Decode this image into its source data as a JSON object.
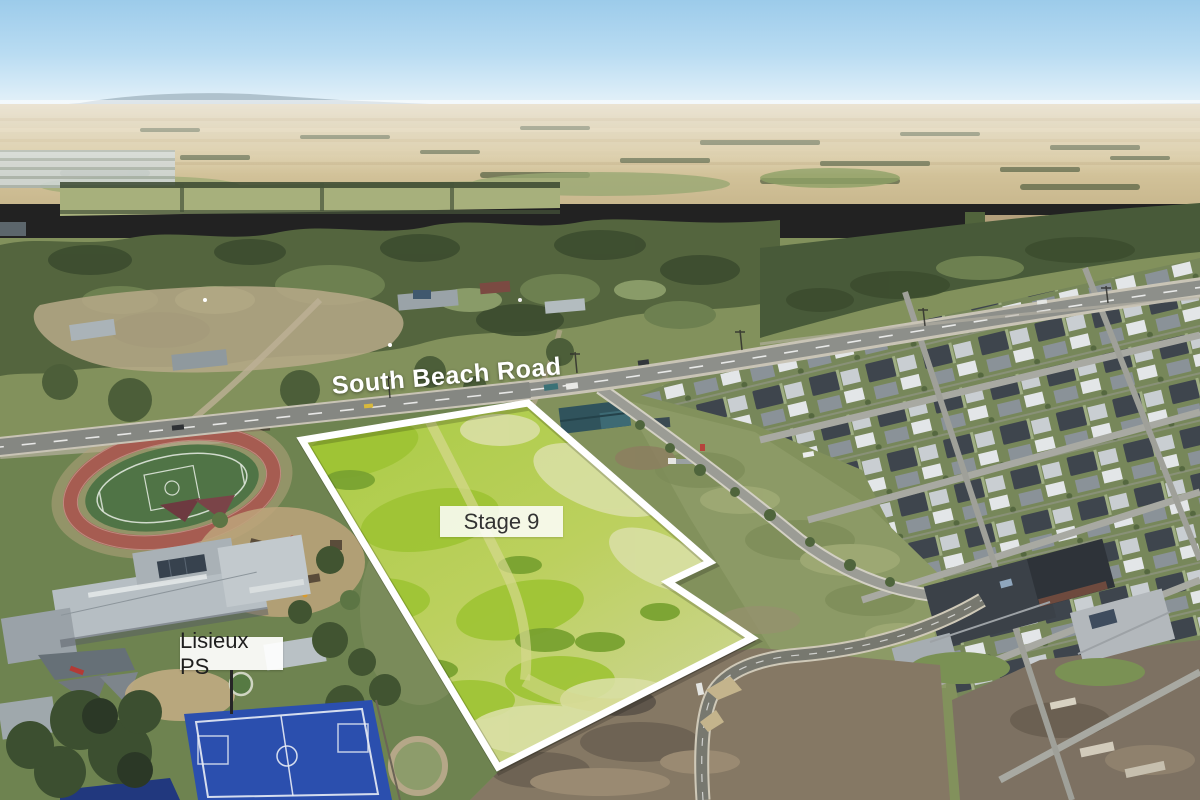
{
  "scene": {
    "type": "aerial-photograph",
    "description": "Drone aerial photo: vacant Stage 9 land parcel outlined in white beside Lisieux Primary School and South Beach Road, with rural paddocks behind and a new housing estate to the east"
  },
  "annotations": {
    "road_label": {
      "text": "South Beach Road",
      "color": "#ffffff"
    },
    "stage_label": {
      "text": "Stage 9",
      "text_color": "#333333",
      "bg_color": "#ffffff"
    },
    "school_label": {
      "text": "Lisieux PS",
      "text_color": "#1f1f1f",
      "bg_color": "#ffffff"
    }
  },
  "key_colors": {
    "sky": "#a5d2ee",
    "haze": "#e9f3f7",
    "far_fields": "#d2c199",
    "tree_band": "#55663f",
    "parcel_bright_green": "#aecb42",
    "boundary_outline": "#ffffff",
    "road_asphalt": "#8d8f8a",
    "athletics_track": "#a65c51",
    "sports_court_blue": "#2b4fae",
    "estate_roof_dark": "#3e454d",
    "estate_roof_light": "#c9ced2",
    "dirt": "#857864"
  }
}
